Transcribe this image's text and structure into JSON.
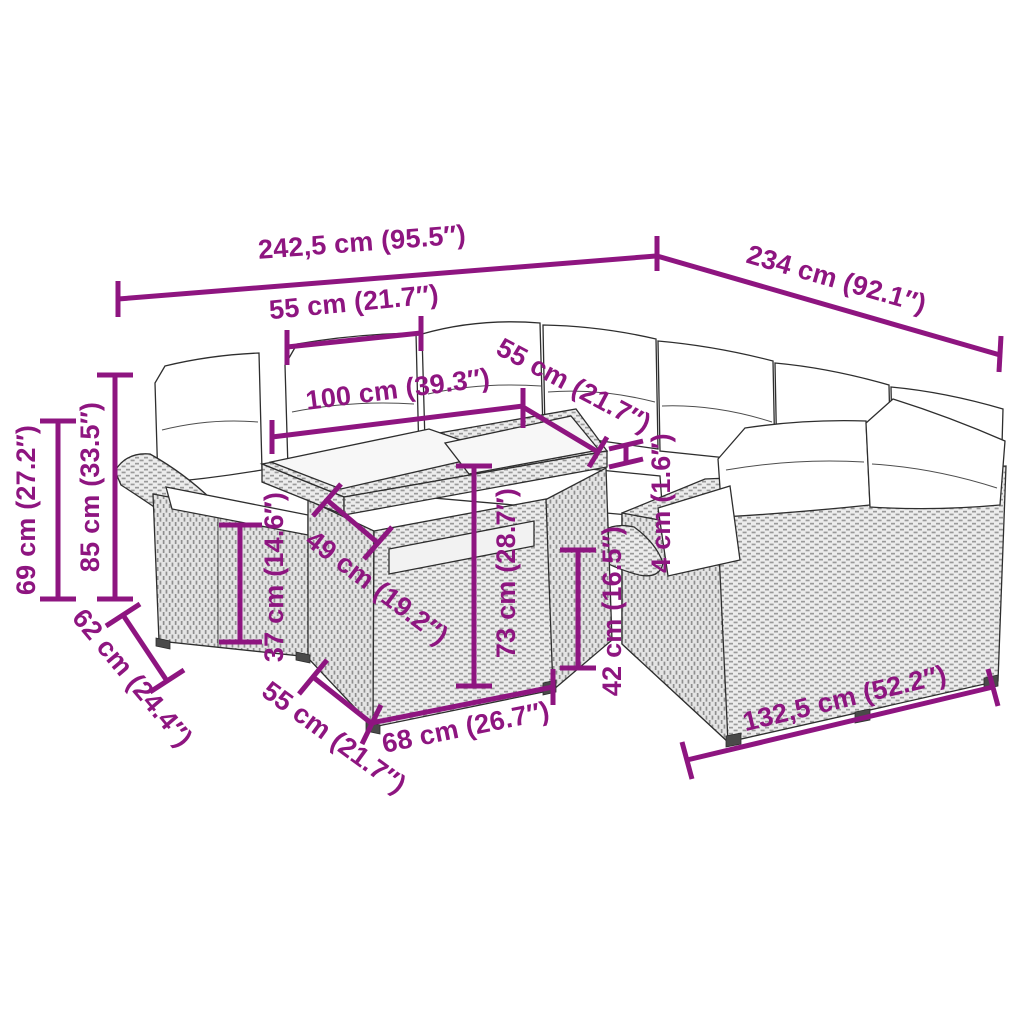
{
  "diagram": {
    "type": "furniture-dimension-diagram",
    "subject": "poly-rattan garden lounge set with glass-top table",
    "colors": {
      "dimension": "#8E1580",
      "outline": "#2e2e2e",
      "cushion": "#ffffff",
      "glass": "#f7f7f7",
      "rattan_light": "#ececec",
      "rattan_dark": "#9a9a9a",
      "background": "#ffffff"
    },
    "labels": {
      "overall_width": "242,5 cm (95.5″)",
      "overall_depth": "234 cm (92.1″)",
      "seat_width": "55 cm (21.7″)",
      "table_length": "100 cm (39.3″)",
      "seat_depth_right": "55 cm (21.7″)",
      "cushion_thickness": "4 cm (1.6″)",
      "armrest_height": "69 cm (27.2″)",
      "back_height": "85 cm (33.5″)",
      "seat_depth_left": "62 cm (24.4″)",
      "seat_height": "37 cm (14.6″)",
      "table_depth": "49 cm (19.2″)",
      "table_height": "73 cm (28.7″)",
      "right_seat_height": "42 cm (16.5″)",
      "stool_depth": "55 cm (21.7″)",
      "table_width": "68 cm (26.7″)",
      "right_section_width": "132,5 cm (52.2″)"
    }
  }
}
